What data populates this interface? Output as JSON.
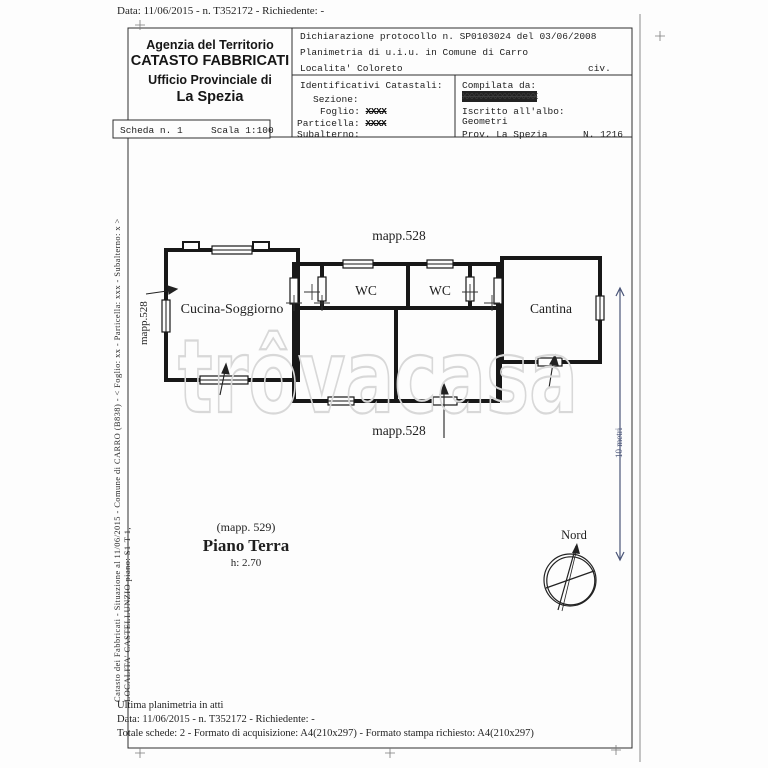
{
  "page": {
    "top_line": "Data: 11/06/2015 - n. T352172 - Richiedente: -",
    "left_margin_line1": "Catasto dei Fabbricati - Situazione al 11/06/2015 - Comune di CARRO (B838) - < Foglio: xx - Particella: xxx - Subalterno: x >",
    "left_margin_line2": "LOCALITA' CASTELLUNZIO piano: S1-T-1,",
    "footer_line1": "Ultima planimetria in atti",
    "footer_line2": "Data: 11/06/2015 - n. T352172 - Richiedente: -",
    "footer_line3": "Totale schede: 2 - Formato di acquisizione: A4(210x297) - Formato stampa richiesto: A4(210x297)"
  },
  "header": {
    "agency": [
      "Agenzia del Territorio",
      "CATASTO FABBRICATI",
      "Ufficio Provinciale di",
      "La Spezia"
    ],
    "scheda": "Scheda n. 1",
    "scala": "Scala 1:100",
    "dichiarazione": "Dichiarazione protocollo n. SP0103024 del 03/06/2008",
    "planimetria": "Planimetria di u.i.u. in Comune di Carro",
    "localita": "Localita' Coloreto",
    "civ": "civ.",
    "identificativi": {
      "title": "Identificativi Catastali:",
      "sezione_label": "Sezione:",
      "foglio_label": "Foglio:",
      "foglio_value": "XXXX",
      "particella_label": "Particella:",
      "particella_value": "XXXX",
      "subalterno_label": "Subalterno:"
    },
    "compilata": {
      "label": "Compilata da:",
      "name_redacted": "XXXXXXXXXXXXXXXX",
      "albo_label": "Iscritto all'albo:",
      "albo_value": "Geometri",
      "prov": "Prov. La Spezia",
      "numero": "N. 1216"
    }
  },
  "plan": {
    "mapp_top": "mapp.528",
    "mapp_left": "mapp.528",
    "mapp_bottom": "mapp.528",
    "room_cucina": "Cucina-Soggiorno",
    "room_wc1": "WC",
    "room_wc2": "WC",
    "room_cantina": "Cantina",
    "floor_note": "(mapp. 529)",
    "floor_title": "Piano Terra",
    "floor_height": "h: 2.70",
    "compass_label": "Nord",
    "dimension_label": "10 metri",
    "watermark": "trôvacasa"
  },
  "colors": {
    "wall": "#181818",
    "dimension_line": "#4a5578",
    "watermark": "#d8d8d8"
  }
}
